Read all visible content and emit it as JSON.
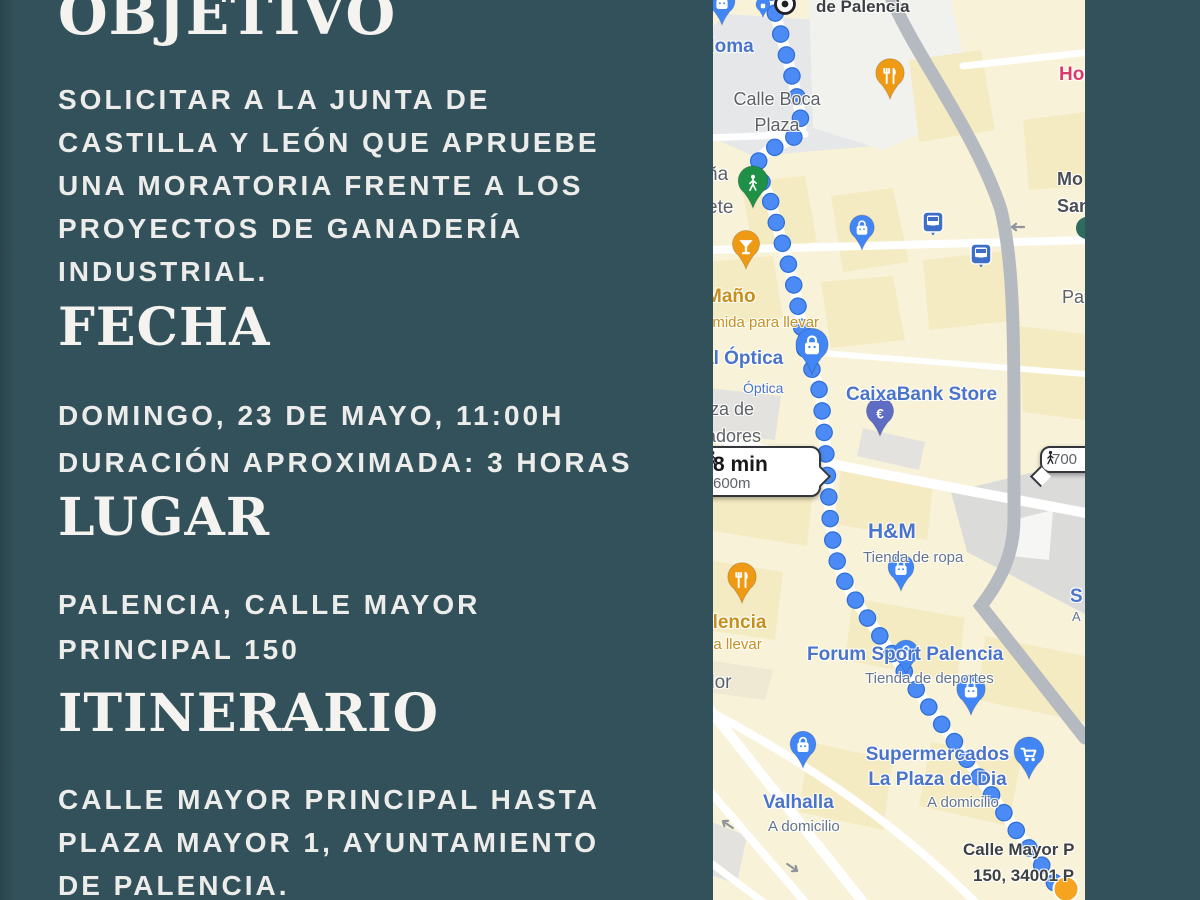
{
  "poster": {
    "objetivo": {
      "heading": "OBJETIVO",
      "lines": [
        "SOLICITAR A LA JUNTA DE",
        "CASTILLA Y LEÓN QUE APRUEBE",
        "UNA MORATORIA FRENTE A LOS",
        "PROYECTOS DE GANADERÍA",
        "INDUSTRIAL."
      ]
    },
    "fecha": {
      "heading": "FECHA",
      "lines": [
        "DOMINGO, 23 DE MAYO, 11:00H",
        "DURACIÓN APROXIMADA: 3 HORAS"
      ]
    },
    "lugar": {
      "heading": "LUGAR",
      "lines": [
        "PALENCIA, CALLE MAYOR",
        "PRINCIPAL 150"
      ]
    },
    "itinerario": {
      "heading": "ITINERARIO",
      "lines": [
        "CALLE MAYOR PRINCIPAL HASTA",
        "PLAZA MAYOR 1, AYUNTAMIENTO",
        "DE PALENCIA."
      ]
    }
  },
  "map": {
    "labels": {
      "de_palencia": "de Palencia",
      "doma": "doma",
      "calle_boca_plaza": "Calle Boca\nPlaza",
      "na_ete": "ña\nete",
      "mano": "Maño",
      "mano_sub": "omida para llevar",
      "al_optica": "al Óptica",
      "optica_sub": "Óptica",
      "plaza_radores": "aza de\nradores",
      "caixabank": "CaixaBank Store",
      "hm": "H&M",
      "hm_sub": "Tienda de ropa",
      "forum": "Forum Sport Palencia",
      "forum_sub": "Tienda de deportes",
      "supermercados": "Supermercados\nLa Plaza de Dia",
      "supermercados_sub": "A domicilio",
      "valhalla": "Valhalla",
      "valhalla_sub": "A domicilio",
      "dor": "dor",
      "alencia": "alencia",
      "ara_llevar": "ara llevar",
      "ho": "Ho",
      "mo_sa": "Mo\nSan",
      "pa": "Pa",
      "s_frag": "S",
      "a_frag": "A",
      "calle_mayor_line1": "Calle Mayor P",
      "calle_mayor_line2": "150, 34001 P"
    },
    "callouts": {
      "left": {
        "duration": "8 min",
        "distance": "600m"
      },
      "right": {
        "distance": "700"
      }
    },
    "icons": {
      "euro": "€"
    }
  },
  "colors": {
    "background": "#33515a",
    "route_blue": "#4c8bf5",
    "pin_blue": "#4285f4",
    "pin_orange": "#ef9a14",
    "pin_green": "#1e9147",
    "pin_indigo": "#5f6cc3"
  }
}
